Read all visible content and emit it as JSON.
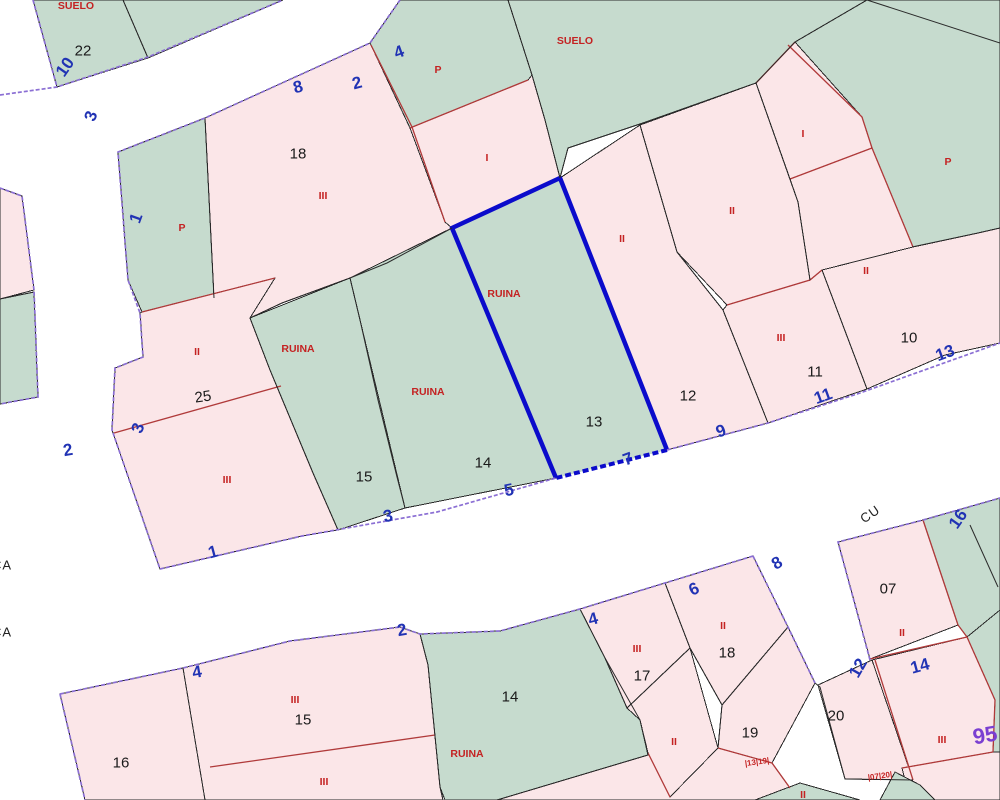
{
  "map": {
    "type": "cadastral-parcel-map",
    "selected_parcel": {
      "number": "13",
      "status": "RUINA"
    },
    "colors": {
      "pink": "#fbe6e8",
      "green": "#c6dbce",
      "purple": "#8b6fd4",
      "redline": "#b03a3a",
      "redmark": "#c42222",
      "black": "#2a2a2a",
      "blue": "#2133b4",
      "highlight": "#0b0bcb",
      "violet": "#7a3fd1"
    },
    "labels": [
      {
        "t": "SUELO",
        "x": 76,
        "y": 6,
        "r": 0,
        "c": "cls",
        "n": "suelo-label"
      },
      {
        "t": "SUELO",
        "x": 575,
        "y": 41,
        "r": 0,
        "c": "cls",
        "n": "suelo-label"
      },
      {
        "t": "P",
        "x": 438,
        "y": 70,
        "r": 0,
        "c": "cls",
        "n": "class-mark-p"
      },
      {
        "t": "I",
        "x": 487,
        "y": 158,
        "r": 0,
        "c": "cls",
        "n": "class-mark-i"
      },
      {
        "t": "P",
        "x": 182,
        "y": 228,
        "r": 0,
        "c": "cls",
        "n": "class-mark-p"
      },
      {
        "t": "II",
        "x": 197,
        "y": 352,
        "r": 0,
        "c": "cls",
        "n": "class-mark-ii"
      },
      {
        "t": "III",
        "x": 227,
        "y": 480,
        "r": 0,
        "c": "cls",
        "n": "class-mark-iii"
      },
      {
        "t": "III",
        "x": 323,
        "y": 196,
        "r": 0,
        "c": "cls",
        "n": "class-mark-iii"
      },
      {
        "t": "RUINA",
        "x": 298,
        "y": 349,
        "r": 0,
        "c": "cls",
        "n": "ruina-label"
      },
      {
        "t": "RUINA",
        "x": 428,
        "y": 392,
        "r": 0,
        "c": "cls",
        "n": "ruina-label"
      },
      {
        "t": "RUINA",
        "x": 504,
        "y": 294,
        "r": 0,
        "c": "cls",
        "n": "ruina-label"
      },
      {
        "t": "II",
        "x": 622,
        "y": 239,
        "r": 0,
        "c": "cls",
        "n": "class-mark-ii"
      },
      {
        "t": "II",
        "x": 732,
        "y": 211,
        "r": 0,
        "c": "cls",
        "n": "class-mark-ii"
      },
      {
        "t": "III",
        "x": 781,
        "y": 338,
        "r": 0,
        "c": "cls",
        "n": "class-mark-iii"
      },
      {
        "t": "I",
        "x": 803,
        "y": 134,
        "r": 0,
        "c": "cls",
        "n": "class-mark-i"
      },
      {
        "t": "P",
        "x": 948,
        "y": 162,
        "r": 0,
        "c": "cls",
        "n": "class-mark-p"
      },
      {
        "t": "II",
        "x": 866,
        "y": 271,
        "r": 0,
        "c": "cls",
        "n": "class-mark-ii"
      },
      {
        "t": "III",
        "x": 295,
        "y": 700,
        "r": 0,
        "c": "cls",
        "n": "class-mark-iii"
      },
      {
        "t": "III",
        "x": 324,
        "y": 782,
        "r": 0,
        "c": "cls",
        "n": "class-mark-iii"
      },
      {
        "t": "RUINA",
        "x": 467,
        "y": 754,
        "r": 0,
        "c": "cls",
        "n": "ruina-label"
      },
      {
        "t": "III",
        "x": 637,
        "y": 649,
        "r": 0,
        "c": "cls",
        "n": "class-mark-iii"
      },
      {
        "t": "II",
        "x": 674,
        "y": 742,
        "r": 0,
        "c": "cls",
        "n": "class-mark-ii"
      },
      {
        "t": "II",
        "x": 723,
        "y": 626,
        "r": 0,
        "c": "cls",
        "n": "class-mark-ii"
      },
      {
        "t": "II",
        "x": 803,
        "y": 795,
        "r": 0,
        "c": "cls",
        "n": "class-mark-ii"
      },
      {
        "t": "II",
        "x": 902,
        "y": 633,
        "r": 0,
        "c": "cls",
        "n": "class-mark-ii"
      },
      {
        "t": "III",
        "x": 942,
        "y": 740,
        "r": 0,
        "c": "cls",
        "n": "class-mark-iii"
      },
      {
        "t": "22",
        "x": 83,
        "y": 51,
        "r": 0,
        "c": "num",
        "n": "parcel-number-22"
      },
      {
        "t": "18",
        "x": 298,
        "y": 154,
        "r": 0,
        "c": "num",
        "n": "parcel-number-18"
      },
      {
        "t": "25",
        "x": 203,
        "y": 397,
        "r": -8,
        "c": "num",
        "n": "parcel-number-25"
      },
      {
        "t": "15",
        "x": 364,
        "y": 477,
        "r": 0,
        "c": "num",
        "n": "parcel-number-15"
      },
      {
        "t": "14",
        "x": 483,
        "y": 463,
        "r": 0,
        "c": "num",
        "n": "parcel-number-14"
      },
      {
        "t": "13",
        "x": 594,
        "y": 422,
        "r": 0,
        "c": "num",
        "n": "parcel-number-13"
      },
      {
        "t": "12",
        "x": 688,
        "y": 396,
        "r": 0,
        "c": "num",
        "n": "parcel-number-12"
      },
      {
        "t": "11",
        "x": 815,
        "y": 372,
        "r": 0,
        "c": "num",
        "n": "parcel-number-11"
      },
      {
        "t": "10",
        "x": 909,
        "y": 338,
        "r": 0,
        "c": "num",
        "n": "parcel-number-10"
      },
      {
        "t": "16",
        "x": 121,
        "y": 763,
        "r": 0,
        "c": "num",
        "n": "parcel-number-16"
      },
      {
        "t": "15",
        "x": 303,
        "y": 720,
        "r": 0,
        "c": "num",
        "n": "parcel-number-15"
      },
      {
        "t": "14",
        "x": 510,
        "y": 697,
        "r": 0,
        "c": "num",
        "n": "parcel-number-14"
      },
      {
        "t": "17",
        "x": 642,
        "y": 676,
        "r": 0,
        "c": "num",
        "n": "parcel-number-17"
      },
      {
        "t": "18",
        "x": 727,
        "y": 653,
        "r": 0,
        "c": "num",
        "n": "parcel-number-18"
      },
      {
        "t": "19",
        "x": 750,
        "y": 733,
        "r": 0,
        "c": "num",
        "n": "parcel-number-19"
      },
      {
        "t": "20",
        "x": 836,
        "y": 716,
        "r": 0,
        "c": "num",
        "n": "parcel-number-20"
      },
      {
        "t": "07",
        "x": 888,
        "y": 589,
        "r": 0,
        "c": "num",
        "n": "parcel-number-07"
      },
      {
        "t": "10",
        "x": 65,
        "y": 67,
        "r": -55,
        "c": "street",
        "n": "street-number-10"
      },
      {
        "t": "3",
        "x": 91,
        "y": 116,
        "r": -70,
        "c": "street",
        "n": "street-number-3"
      },
      {
        "t": "8",
        "x": 298,
        "y": 87,
        "r": -15,
        "c": "street",
        "n": "street-number-8"
      },
      {
        "t": "2",
        "x": 357,
        "y": 83,
        "r": -15,
        "c": "street",
        "n": "street-number-2"
      },
      {
        "t": "4",
        "x": 399,
        "y": 52,
        "r": -20,
        "c": "street",
        "n": "street-number-4"
      },
      {
        "t": "1",
        "x": 136,
        "y": 218,
        "r": -70,
        "c": "street",
        "n": "street-number-1"
      },
      {
        "t": "3",
        "x": 138,
        "y": 428,
        "r": -70,
        "c": "street",
        "n": "street-number-3"
      },
      {
        "t": "2",
        "x": 68,
        "y": 450,
        "r": -10,
        "c": "street",
        "n": "street-number-2"
      },
      {
        "t": "1",
        "x": 213,
        "y": 552,
        "r": -15,
        "c": "street",
        "n": "street-number-1"
      },
      {
        "t": "3",
        "x": 388,
        "y": 516,
        "r": -12,
        "c": "street",
        "n": "street-number-3"
      },
      {
        "t": "5",
        "x": 509,
        "y": 490,
        "r": -12,
        "c": "street",
        "n": "street-number-5"
      },
      {
        "t": "7",
        "x": 628,
        "y": 459,
        "r": -20,
        "c": "street",
        "n": "street-number-7"
      },
      {
        "t": "9",
        "x": 721,
        "y": 431,
        "r": -20,
        "c": "street",
        "n": "street-number-9"
      },
      {
        "t": "11",
        "x": 823,
        "y": 396,
        "r": -20,
        "c": "street",
        "n": "street-number-11"
      },
      {
        "t": "13",
        "x": 945,
        "y": 353,
        "r": -20,
        "c": "street",
        "n": "street-number-13"
      },
      {
        "t": "4",
        "x": 197,
        "y": 672,
        "r": -10,
        "c": "street",
        "n": "street-number-4"
      },
      {
        "t": "2",
        "x": 402,
        "y": 630,
        "r": -10,
        "c": "street",
        "n": "street-number-2"
      },
      {
        "t": "4",
        "x": 593,
        "y": 619,
        "r": -15,
        "c": "street",
        "n": "street-number-4"
      },
      {
        "t": "6",
        "x": 694,
        "y": 589,
        "r": -25,
        "c": "street",
        "n": "street-number-6"
      },
      {
        "t": "8",
        "x": 777,
        "y": 563,
        "r": -30,
        "c": "street",
        "n": "street-number-8"
      },
      {
        "t": "12",
        "x": 858,
        "y": 668,
        "r": -60,
        "c": "street",
        "n": "street-number-12"
      },
      {
        "t": "14",
        "x": 920,
        "y": 666,
        "r": -15,
        "c": "street",
        "n": "street-number-14"
      },
      {
        "t": "16",
        "x": 958,
        "y": 519,
        "r": -55,
        "c": "street",
        "n": "street-number-16"
      },
      {
        "t": "CU",
        "x": 870,
        "y": 514,
        "r": -35,
        "c": "name",
        "n": "street-name-cu"
      },
      {
        "t": "CA",
        "x": 2,
        "y": 565,
        "r": 0,
        "c": "name",
        "n": "street-name-ca"
      },
      {
        "t": "CA",
        "x": 2,
        "y": 632,
        "r": 0,
        "c": "name",
        "n": "street-name-ca"
      },
      {
        "t": "95",
        "x": 985,
        "y": 735,
        "r": -10,
        "c": "big",
        "n": "map-sheet-number-95"
      },
      {
        "t": "|13|19|",
        "x": 757,
        "y": 762,
        "r": -8,
        "c": "tiny",
        "n": "map-code"
      },
      {
        "t": "|07|20|",
        "x": 880,
        "y": 776,
        "r": -8,
        "c": "tiny",
        "n": "map-code"
      }
    ]
  }
}
